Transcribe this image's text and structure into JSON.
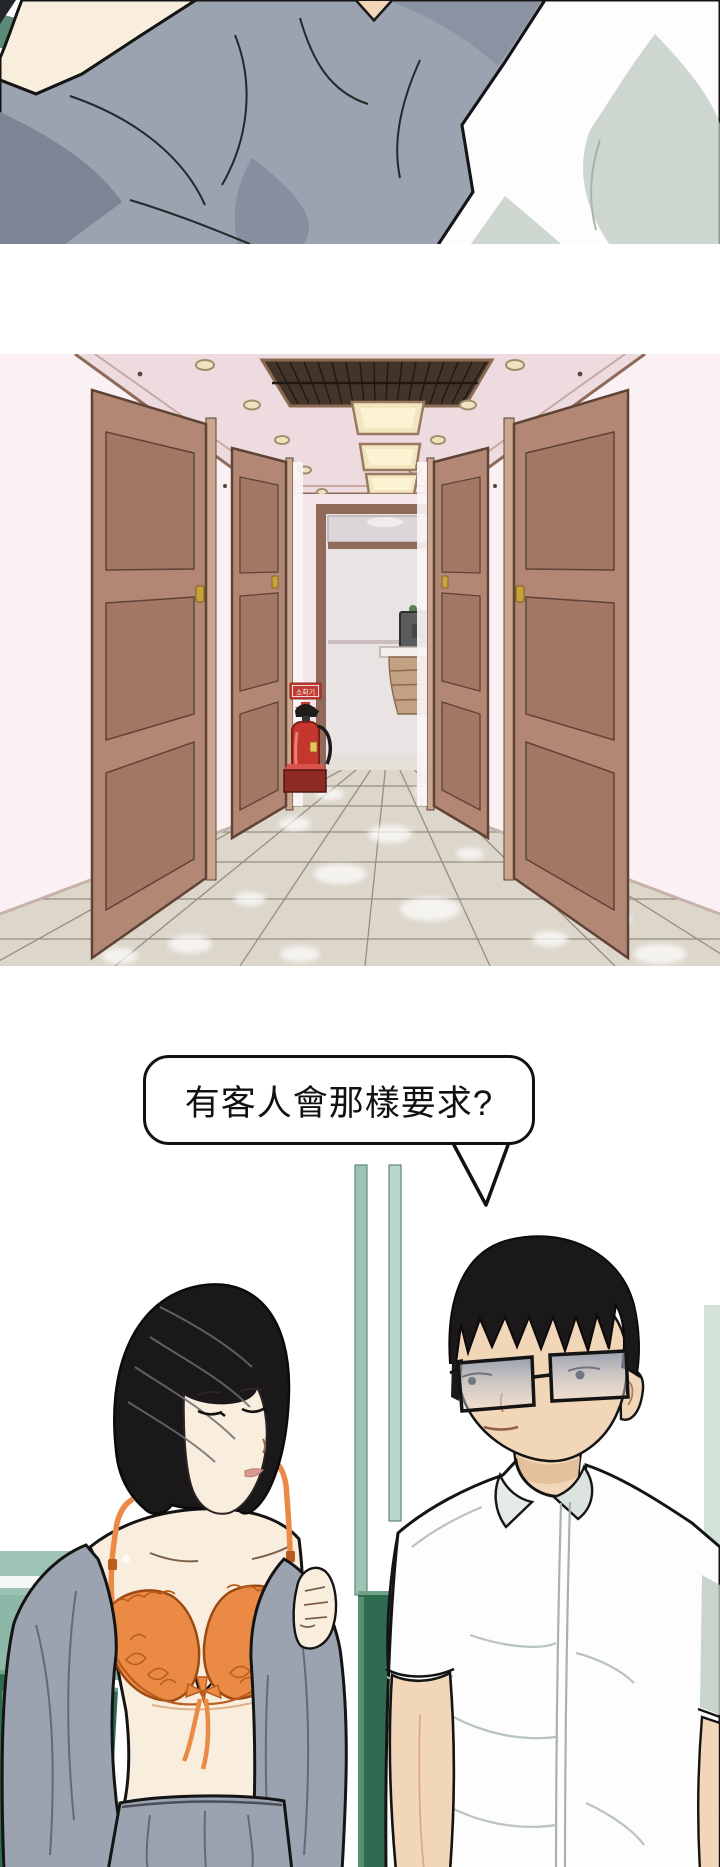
{
  "speech_bubble": {
    "text": "有客人會那樣要求?"
  },
  "hallway": {
    "fire_sign_text": "소화기"
  },
  "colors": {
    "paper": "#ffffff",
    "ink": "#111111",
    "skin-light": "#f9eedd",
    "skin-warm": "#f2d6b8",
    "skin-shadow": "#e5c09c",
    "fabric-gray": "#9ba3b0",
    "fabric-gray-dark": "#7d8595",
    "fold-gray": "#626b79",
    "shirt-white": "#fdfdfd",
    "shirt-shadow": "#bcc9c0",
    "teal-band": "#9cc3b3",
    "teal-light": "#b9d8cb",
    "teal-dark": "#5d8a76",
    "bench-green": "#2e6b50",
    "bench-light": "#6fa387",
    "hall-bg": "#fbf0f3",
    "hall-ceiling": "#eedbe0",
    "hall-endwall": "#f4e5e9",
    "trim-brown": "#8f6a5b",
    "door-brown": "#b28774",
    "door-panel": "#a27763",
    "door-dark": "#5f4336",
    "frame-light": "#caa58f",
    "vent-dark": "#43342a",
    "light-warm": "#f2e6c0",
    "light-bright": "#fbf3d2",
    "floor-tile": "#dcd6cb",
    "tile-line": "#7e7767",
    "sign-red": "#c23a32",
    "ext-red": "#c5372e",
    "ext-dark": "#8e2a24",
    "brass": "#c9a23a",
    "hair-black": "#1b1819",
    "hair-shine": "#6f6b70",
    "bra-orange": "#ea8a45",
    "bra-deep": "#b95c1d",
    "lip-rose": "#d89a91",
    "interior-gray": "#eae3e4",
    "desk-tan": "#c3a183",
    "monitor-gray": "#5c5c5e"
  }
}
